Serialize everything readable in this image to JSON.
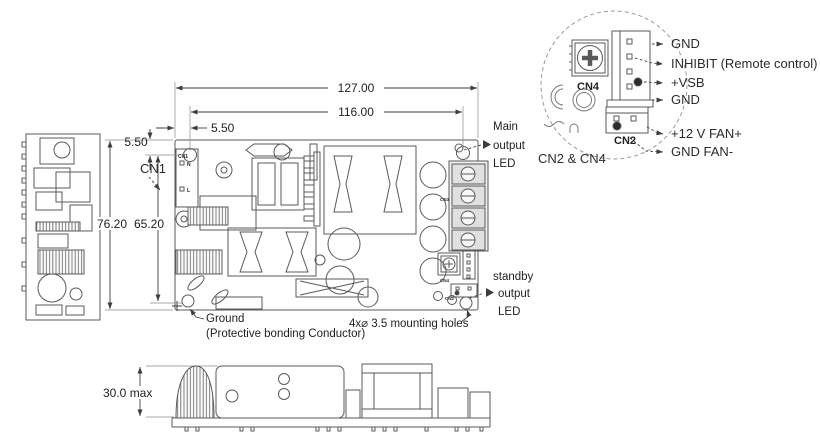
{
  "dimensions": {
    "overall_width": "127.00",
    "hole_pitch_x": "116.00",
    "hole_offset_x": "5.50",
    "hole_offset_y": "5.50",
    "overall_height": "76.20",
    "hole_pitch_y": "65.20",
    "max_component_height": "30.0 max"
  },
  "callouts": {
    "cn1": "CN1",
    "main_led": {
      "l1": "Main",
      "l2": "output",
      "l3": "LED"
    },
    "standby_led": {
      "l1": "standby",
      "l2": "output",
      "l3": "LED"
    },
    "ground": {
      "l1": "Ground",
      "l2": "(Protective bonding Conductor)"
    },
    "mounting_holes": "4x⌀ 3.5 mounting holes"
  },
  "board_labels": {
    "cn1": "CN1",
    "pin_n": "N",
    "pin_l": "L",
    "cn3": "CN3",
    "cn4": "CN4",
    "cn2": "CN2"
  },
  "detail": {
    "caption": "CN2 & CN4",
    "cn4_label": "CN4",
    "cn2_label": "CN2",
    "pins": [
      "GND",
      "INHIBIT (Remote control)",
      "+VSB",
      "GND",
      "+12 V FAN+",
      "GND FAN-"
    ]
  },
  "colors": {
    "line": "#555555",
    "dim_line": "#3d3d3d",
    "text": "#1f1f1f",
    "background": "#ffffff"
  }
}
